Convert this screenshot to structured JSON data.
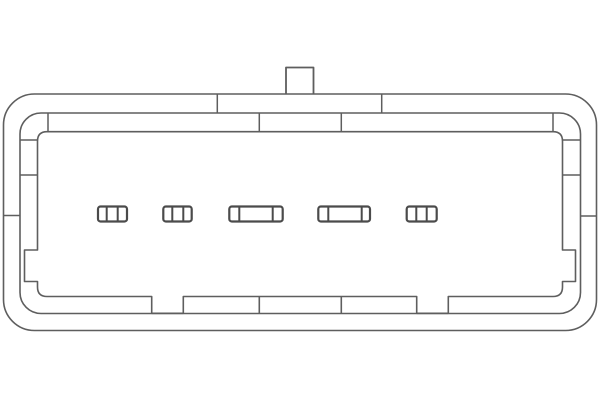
{
  "meta": {
    "title": "Technical line drawing: 5-pin electrical connector housing, front view",
    "background_color": "#ffffff",
    "line_color": "#5e5e5e",
    "slot_line_color": "#4b4b4b"
  },
  "diagram": {
    "canvas": {
      "width": 600,
      "height": 400
    },
    "pin_count": 5,
    "mounting_tab": {
      "x": 286,
      "y": 67.5,
      "width": 27.5,
      "height": 27
    },
    "outer_housing": {
      "x": 3.5,
      "y": 94,
      "width": 593,
      "height": 236.5,
      "corner_radius": 31
    },
    "middle_housing": {
      "x": 20,
      "y": 113,
      "width": 560.5,
      "height": 200.5,
      "corner_radius": 21
    },
    "inner_cavity": {
      "left": 37.5,
      "right": 562.5,
      "top": 131.7,
      "corner_radius": 9.5,
      "notch_top": 296.5,
      "base": 313.3,
      "top_inset_left": 48,
      "top_inset_right": 553,
      "bottom_gaps": [
        [
          151.7,
          183.3
        ],
        [
          416.7,
          448.3
        ]
      ],
      "bottom_dividers": [
        259.3,
        341.3
      ],
      "side_pockets": {
        "y1": 250,
        "y2": 281.5,
        "left_wall_x": 24.5,
        "right_wall_x": 575.5
      }
    },
    "top_steps": [
      {
        "name": "outer-step-left",
        "x1": 217.3,
        "y1": 94,
        "x2": 217.3,
        "y2": 113
      },
      {
        "name": "outer-step-right",
        "x1": 381.7,
        "y1": 94,
        "x2": 381.7,
        "y2": 113
      },
      {
        "name": "mid-step-left",
        "x1": 259.3,
        "y1": 113,
        "x2": 259.3,
        "y2": 131.7
      },
      {
        "name": "mid-step-right",
        "x1": 341.3,
        "y1": 113,
        "x2": 341.3,
        "y2": 131.7
      },
      {
        "name": "cavity-corner-step-left",
        "x1": 48,
        "y1": 113,
        "x2": 48,
        "y2": 131.7
      },
      {
        "name": "cavity-corner-step-right",
        "x1": 553,
        "y1": 113,
        "x2": 553,
        "y2": 131.7
      }
    ],
    "band_ticks": [
      {
        "name": "left-outer-band-tick",
        "x1": 3.5,
        "y1": 215.5,
        "x2": 20,
        "y2": 215.5
      },
      {
        "name": "left-inner-band-tick-upper",
        "x1": 20,
        "y1": 140,
        "x2": 37.5,
        "y2": 140
      },
      {
        "name": "left-inner-band-tick-mid",
        "x1": 20,
        "y1": 175,
        "x2": 37.5,
        "y2": 175
      },
      {
        "name": "right-outer-band-tick",
        "x1": 580.5,
        "y1": 216,
        "x2": 597,
        "y2": 216
      },
      {
        "name": "right-inner-band-tick-upper",
        "x1": 562.5,
        "y1": 140,
        "x2": 580.5,
        "y2": 140
      },
      {
        "name": "right-inner-band-tick-mid",
        "x1": 562.5,
        "y1": 175,
        "x2": 580.5,
        "y2": 175
      }
    ],
    "pin_slot_y": 206.5,
    "pin_slot_height": 15,
    "pin_slots": [
      {
        "x": 98,
        "width": 29,
        "dividers": [
          106.7,
          117.7
        ]
      },
      {
        "x": 163.3,
        "width": 28.4,
        "dividers": [
          172.3,
          183.3
        ]
      },
      {
        "x": 229.3,
        "width": 53.4,
        "dividers": [
          239.3,
          272.7
        ]
      },
      {
        "x": 318.3,
        "width": 51.7,
        "dividers": [
          328.3,
          361.7
        ]
      },
      {
        "x": 406.7,
        "width": 30,
        "dividers": [
          416.3,
          426.7
        ]
      }
    ]
  }
}
